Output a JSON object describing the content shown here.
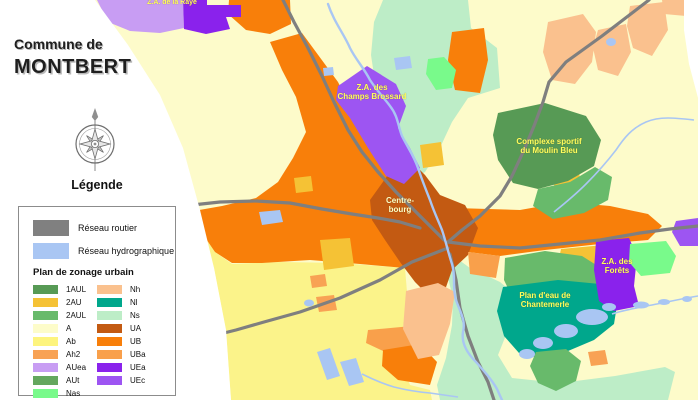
{
  "title": {
    "line1": "Commune de",
    "line2": "MONTBERT"
  },
  "legend": {
    "heading": "Légende",
    "network": {
      "items": [
        {
          "label": "Réseau routier",
          "color": "#808080"
        },
        {
          "label": "Réseau hydrographique",
          "color": "#a9c6f3"
        }
      ]
    },
    "zoning": {
      "heading": "Plan de zonage urbain",
      "items": [
        {
          "code": "1AUL",
          "color": "#579a55"
        },
        {
          "code": "2AU",
          "color": "#f5c235"
        },
        {
          "code": "2AUL",
          "color": "#68ba6b"
        },
        {
          "code": "A",
          "color": "#fdfcca"
        },
        {
          "code": "Ab",
          "color": "#fdf47e"
        },
        {
          "code": "Ah2",
          "color": "#f8a254"
        },
        {
          "code": "AUea",
          "color": "#c89df3"
        },
        {
          "code": "AUt",
          "color": "#64a75e"
        },
        {
          "code": "Nas",
          "color": "#79fa8b"
        },
        {
          "code": "Nh",
          "color": "#fac18e"
        },
        {
          "code": "Nl",
          "color": "#00a78c"
        },
        {
          "code": "Ns",
          "color": "#bdedc7"
        },
        {
          "code": "UA",
          "color": "#c35a12"
        },
        {
          "code": "UB",
          "color": "#f87f0a"
        },
        {
          "code": "UBa",
          "color": "#f9a04b"
        },
        {
          "code": "UEa",
          "color": "#8a22ec"
        },
        {
          "code": "UEc",
          "color": "#9d55f2"
        }
      ]
    }
  },
  "map": {
    "labels": [
      {
        "id": "za-la-raye",
        "line1": "Z.A. de la Raye",
        "line2": ""
      },
      {
        "id": "za-champs-brossard",
        "line1": "Z.A. des",
        "line2": "Champs Brossard"
      },
      {
        "id": "complexe-sportif",
        "line1": "Complexe sportif",
        "line2": "du Moulin Bleu"
      },
      {
        "id": "centre-bourg",
        "line1": "Centre-",
        "line2": "bourg"
      },
      {
        "id": "za-forets",
        "line1": "Z.A. des",
        "line2": "Forêts"
      },
      {
        "id": "plan-eau-chantemerle",
        "line1": "Plan d'eau de",
        "line2": "Chantemerle"
      }
    ]
  }
}
